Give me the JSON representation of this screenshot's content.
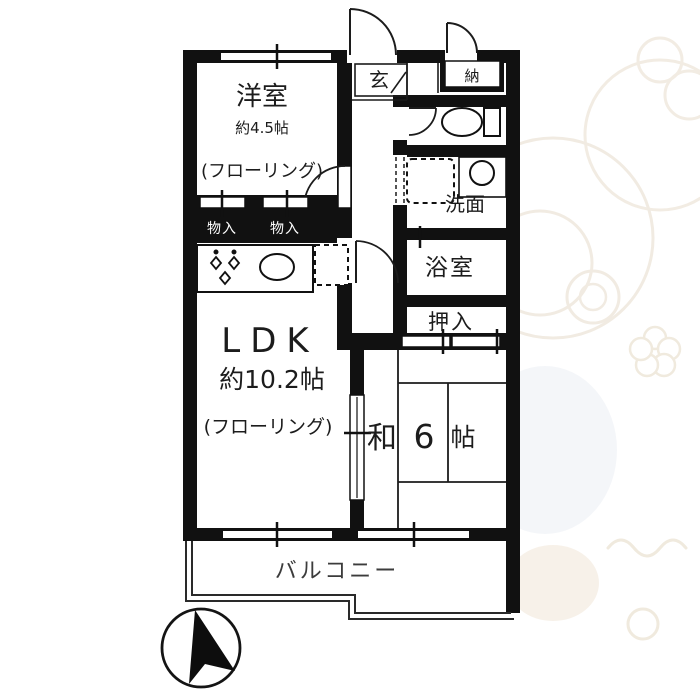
{
  "floorplan": {
    "labels": {
      "western_room": "洋室",
      "western_room_size": "約4.5帖",
      "western_room_floor": "(フローリング)",
      "ldk": "LDK",
      "ldk_size": "約10.2帖",
      "ldk_floor": "(フローリング)",
      "japanese_room_prefix": "和",
      "japanese_room_num": "6",
      "japanese_room_unit": "帖",
      "entrance": "玄",
      "storage_top": "納",
      "washroom": "洗面",
      "bathroom": "浴室",
      "closet": "押入",
      "storage_small_left": "物入",
      "storage_small_right": "物入",
      "balcony": "バルコニー"
    },
    "icons": {
      "north_arrow": "compass-north-arrow",
      "toilet": "toilet-icon",
      "kitchen_sink": "kitchen-sink-icon",
      "stove": "stove-burners-icon",
      "refrigerator": "refrigerator-dashed-box",
      "washing_machine": "washing-machine-dashed-box",
      "washbasin": "washbasin-icon",
      "watermark": "monkey-mascot-watermark"
    },
    "colors": {
      "wall": "#111111",
      "line": "#1c1c1c",
      "balcony_text": "#3c3c3c",
      "watermark_warm": "#f2ebe1",
      "watermark_cool": "#edf1f5"
    }
  }
}
